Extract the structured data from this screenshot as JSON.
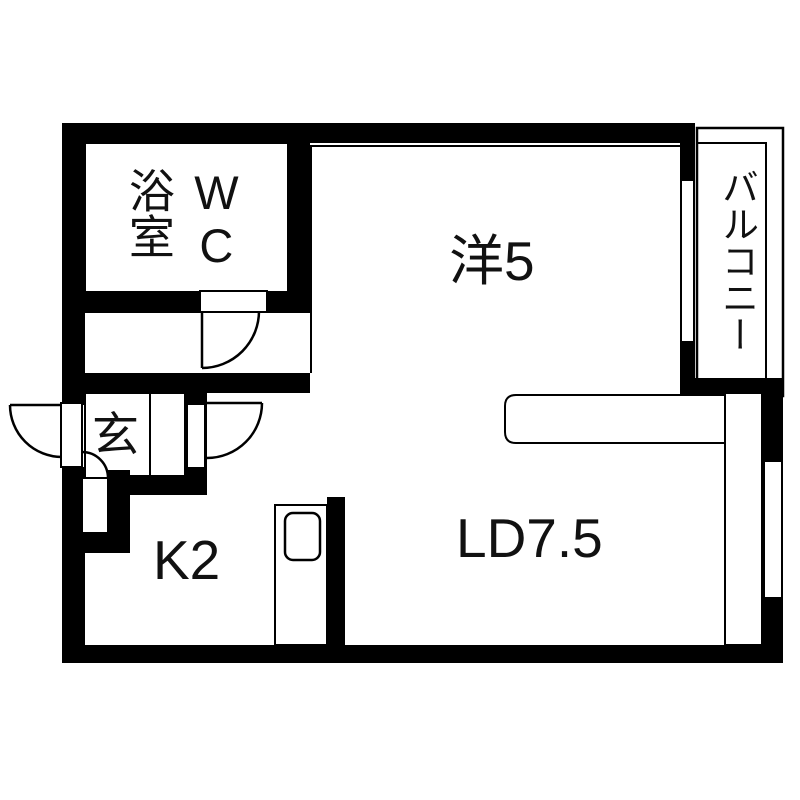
{
  "floorplan": {
    "type": "japanese-apartment-floor-plan",
    "colors": {
      "wall": "#000000",
      "floor": "#ffffff",
      "ink": "#111111"
    },
    "rooms": {
      "bath": {
        "label": "浴室"
      },
      "wc": {
        "label": "WC"
      },
      "western_room": {
        "label": "洋5"
      },
      "balcony": {
        "label": "バルコニー"
      },
      "entrance": {
        "label": "玄"
      },
      "kitchen": {
        "label": "K2"
      },
      "living_dining": {
        "label": "LD7.5"
      }
    }
  }
}
